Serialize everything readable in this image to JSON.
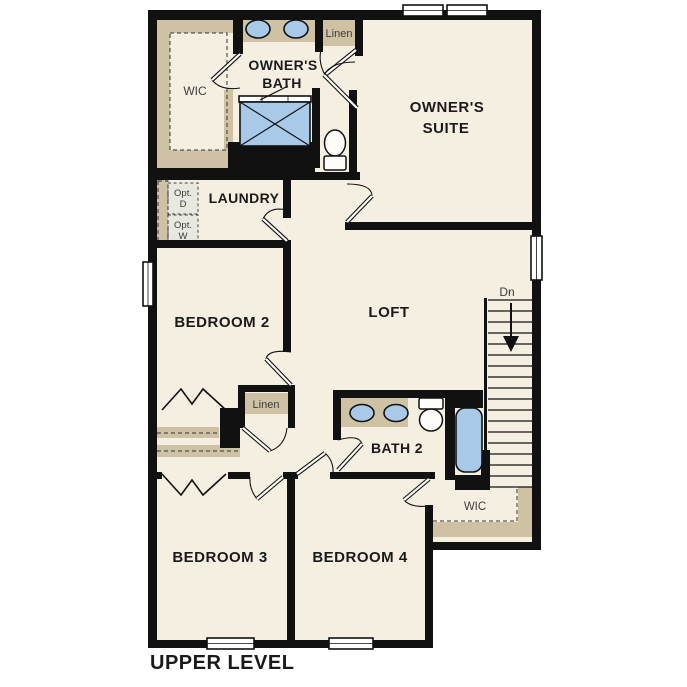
{
  "plan_title": "UPPER LEVEL",
  "rooms": {
    "owners_suite": {
      "line1": "OWNER'S",
      "line2": "SUITE"
    },
    "owners_bath": {
      "line1": "OWNER'S",
      "line2": "BATH"
    },
    "wic_upper": {
      "label": "WIC"
    },
    "laundry": {
      "label": "LAUNDRY"
    },
    "bedroom2": {
      "label": "BEDROOM 2"
    },
    "loft": {
      "label": "LOFT"
    },
    "bath2": {
      "label": "BATH 2"
    },
    "bedroom3": {
      "label": "BEDROOM 3"
    },
    "bedroom4": {
      "label": "BEDROOM 4"
    },
    "wic_lower": {
      "label": "WIC"
    },
    "linen_upper": {
      "label": "Linen"
    },
    "linen_hall": {
      "label": "Linen"
    }
  },
  "annotations": {
    "stairs_direction": "Dn",
    "opt_dryer_line1": "Opt.",
    "opt_dryer_line2": "D",
    "opt_washer_line1": "Opt.",
    "opt_washer_line2": "W"
  },
  "colors": {
    "paper": "#ffffff",
    "floor": "#f5efe2",
    "wall": "#111111",
    "shelf": "#cfc1a4",
    "fixture": "#a9c9e9",
    "optional": "#e7e8e0",
    "label": "#1a1a1a",
    "label_muted": "#3c3c3c"
  }
}
